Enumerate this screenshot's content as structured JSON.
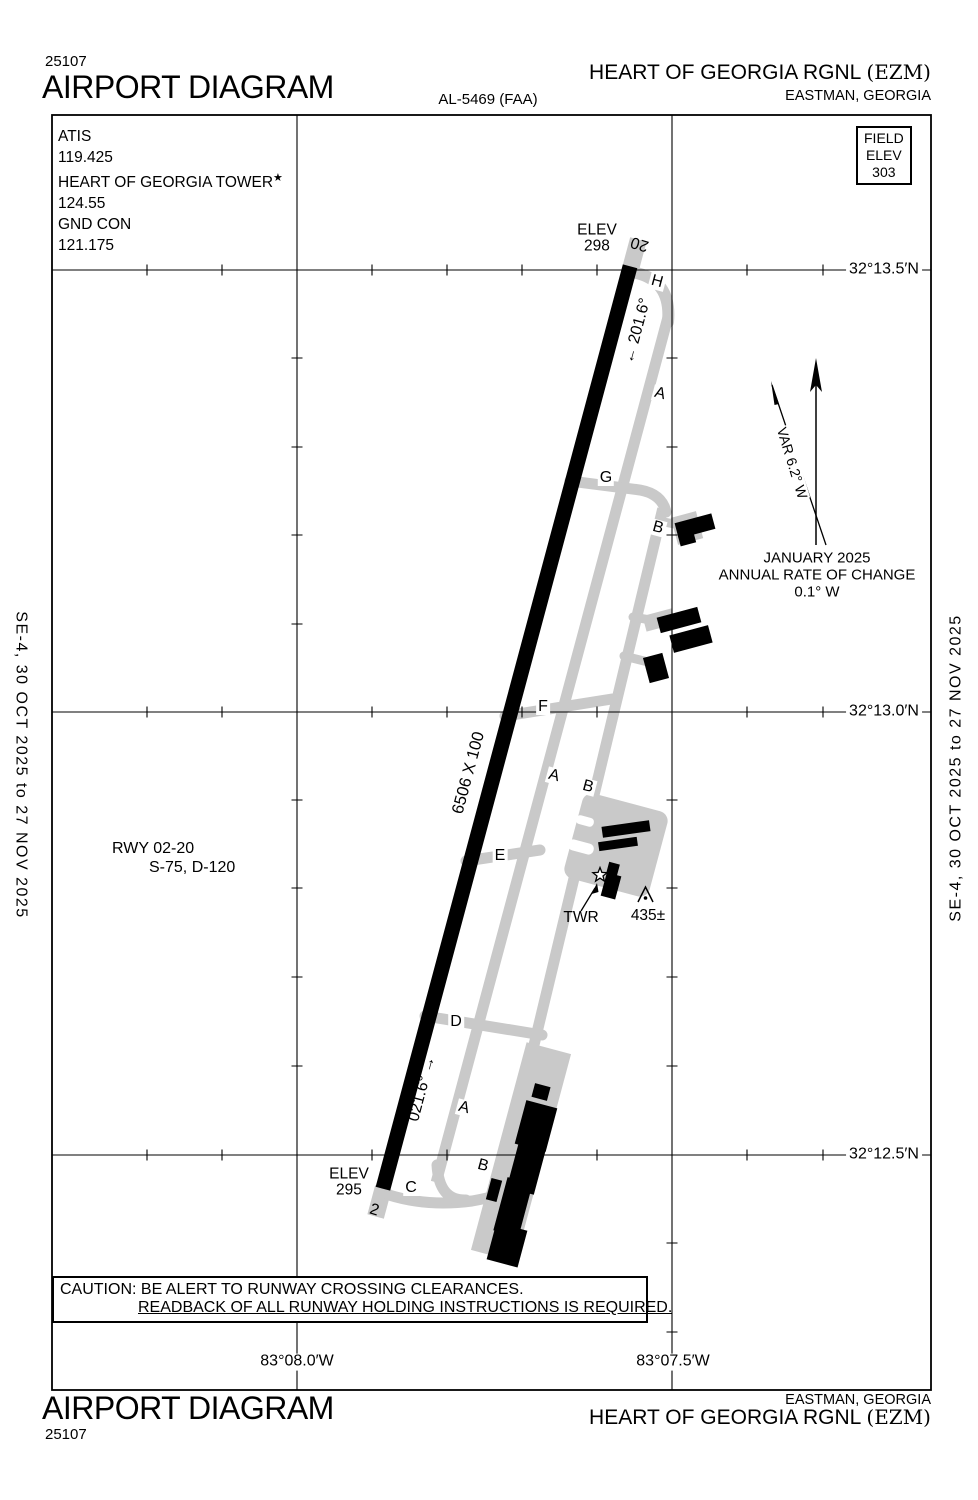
{
  "colors": {
    "pavement": "#c9c9c9",
    "ink": "#000000"
  },
  "header": {
    "chart_number": "25107",
    "title": "AIRPORT DIAGRAM",
    "procedure_id": "AL-5469 (FAA)",
    "airport_name": "HEART OF GEORGIA RGNL",
    "airport_code": "(EZM)",
    "city_state": "EASTMAN, GEORGIA"
  },
  "footer": {
    "chart_number": "25107",
    "title": "AIRPORT DIAGRAM",
    "airport_name": "HEART OF GEORGIA RGNL",
    "airport_code": "(EZM)",
    "city_state": "EASTMAN, GEORGIA"
  },
  "comms": {
    "atis_label": "ATIS",
    "atis_freq": "119.425",
    "tower_label": "HEART OF GEORGIA TOWER",
    "tower_star": "★",
    "tower_freq": "124.55",
    "ground_label": "GND CON",
    "ground_freq": "121.175"
  },
  "field_elevation": {
    "label_line1": "FIELD",
    "label_line2": "ELEV",
    "value": "303"
  },
  "magnetic_variation": {
    "var_text": "VAR 6.2° W",
    "date": "JANUARY 2025",
    "rate_label": "ANNUAL RATE OF CHANGE",
    "rate_value": "0.1° W"
  },
  "runway": {
    "dimensions": "6506 X 100",
    "info_line1": "RWY 02-20",
    "info_line2": "S-75, D-120",
    "end_20": {
      "elev_label": "ELEV",
      "elev_value": "298",
      "number": "20",
      "heading": "← 201.6°"
    },
    "end_02": {
      "elev_label": "ELEV",
      "elev_value": "295",
      "number": "2",
      "heading": "021.6° →"
    }
  },
  "taxiway_labels": [
    "H",
    "A",
    "G",
    "B",
    "F",
    "A",
    "B",
    "E",
    "D",
    "A",
    "B",
    "C"
  ],
  "tower": {
    "label": "TWR"
  },
  "obstruction": {
    "value": "435±"
  },
  "grid": {
    "latitudes": [
      "32°13.5′N",
      "32°13.0′N",
      "32°12.5′N"
    ],
    "longitudes": [
      "83°08.0′W",
      "83°07.5′W"
    ]
  },
  "edge_note": "SE-4,  30 OCT 2025  to  27 NOV 2025",
  "caution": {
    "line1": "CAUTION: BE ALERT TO RUNWAY CROSSING CLEARANCES.",
    "line2": "READBACK OF ALL RUNWAY HOLDING INSTRUCTIONS IS REQUIRED."
  }
}
